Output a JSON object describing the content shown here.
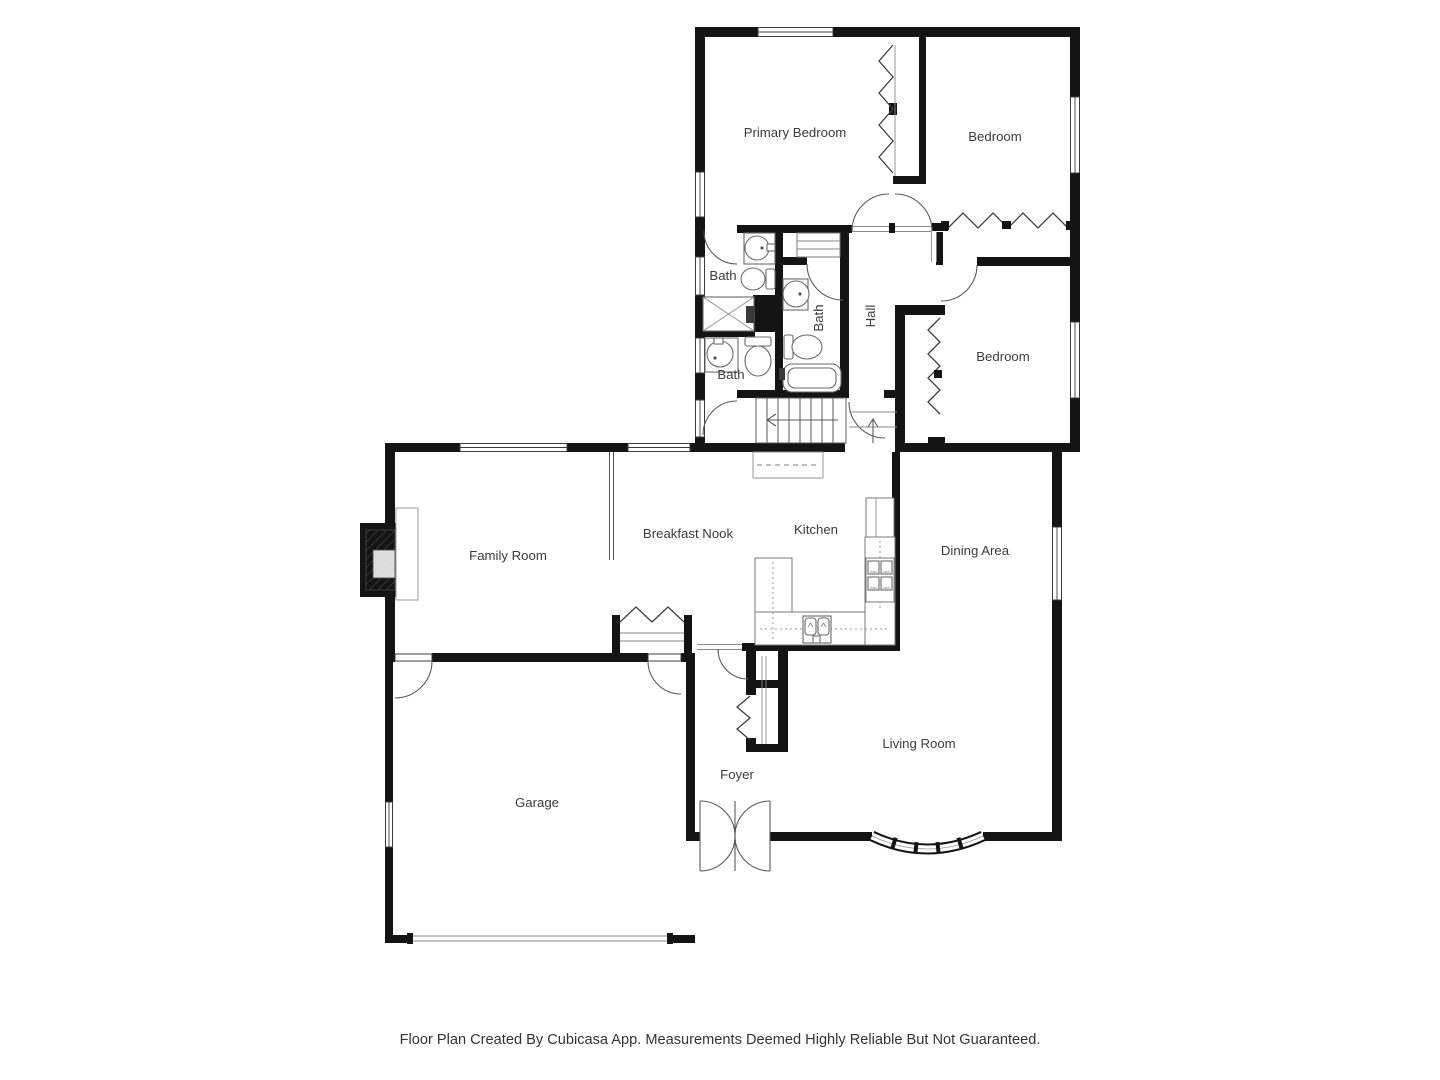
{
  "title": "Floor Plan",
  "footer": "Floor Plan Created By Cubicasa App. Measurements Deemed Highly Reliable But Not Guaranteed.",
  "rooms": {
    "primary_bedroom": "Primary Bedroom",
    "bedroom_top": "Bedroom",
    "bath_upper": "Bath",
    "bath_mid": "Bath",
    "hall": "Hall",
    "bath_lower": "Bath",
    "bedroom_right": "Bedroom",
    "family_room": "Family Room",
    "breakfast_nook": "Breakfast Nook",
    "kitchen": "Kitchen",
    "dining_area": "Dining Area",
    "garage": "Garage",
    "foyer": "Foyer",
    "living_room": "Living Room"
  },
  "colors": {
    "wall": "#141414",
    "line": "#4d4d4d",
    "text": "#3b3b3b",
    "background": "#ffffff"
  }
}
